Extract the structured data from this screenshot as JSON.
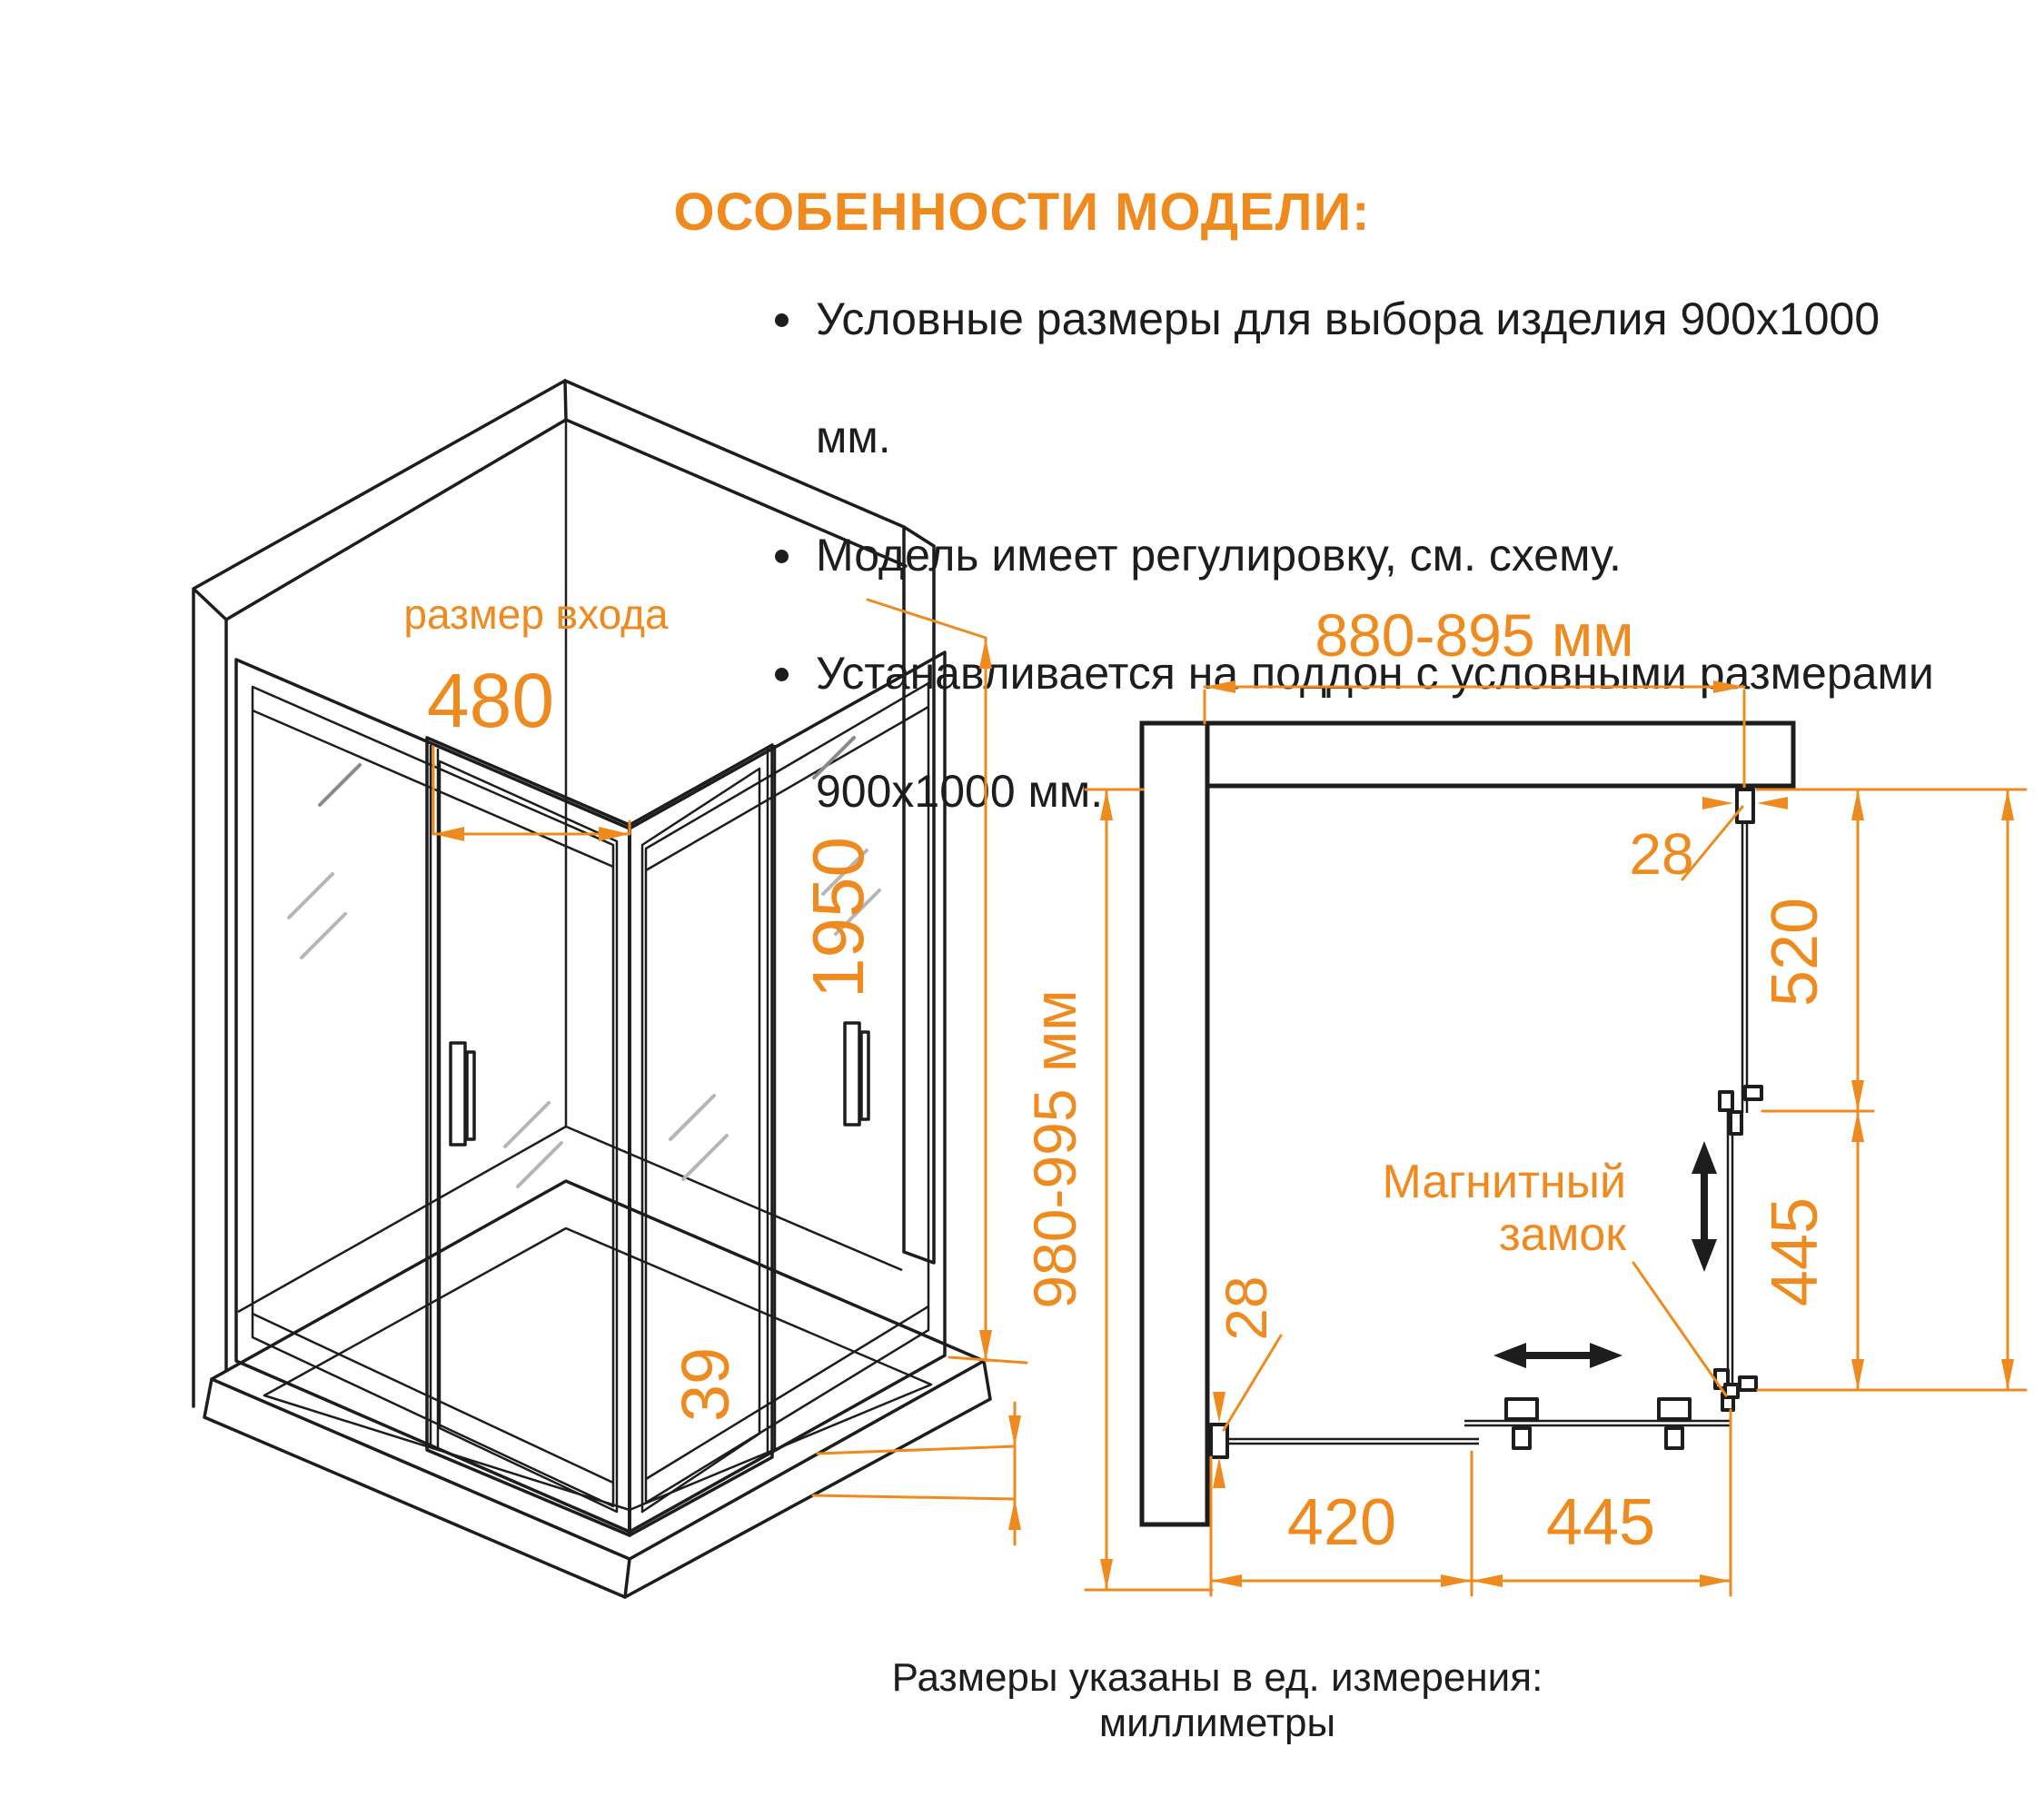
{
  "features": {
    "title": "ОСОБЕННОСТИ МОДЕЛИ:",
    "items": [
      "Условные размеры для выбора изделия 900x1000 мм.",
      "Модель имеет регулировку, см. схему.",
      "Устанавливается на поддон с условными размерами 900x1000 мм."
    ]
  },
  "iso": {
    "entrance_label": "размер входа",
    "entrance_width": "480",
    "height": "1950",
    "base_height": "39"
  },
  "plan": {
    "width_range": "880-895 мм",
    "depth_range": "980-995 мм",
    "top_profile": "28",
    "right_fixed": "520",
    "right_door": "445",
    "bottom_profile": "28",
    "bottom_fixed": "420",
    "bottom_door": "445",
    "lock_line1": "Магнитный",
    "lock_line2": "замок"
  },
  "footer": {
    "note": "Размеры указаны в ед. измерения: миллиметры"
  },
  "colors": {
    "accent": "#ef8a1e",
    "line": "#1d1d1d",
    "background": "#ffffff"
  }
}
